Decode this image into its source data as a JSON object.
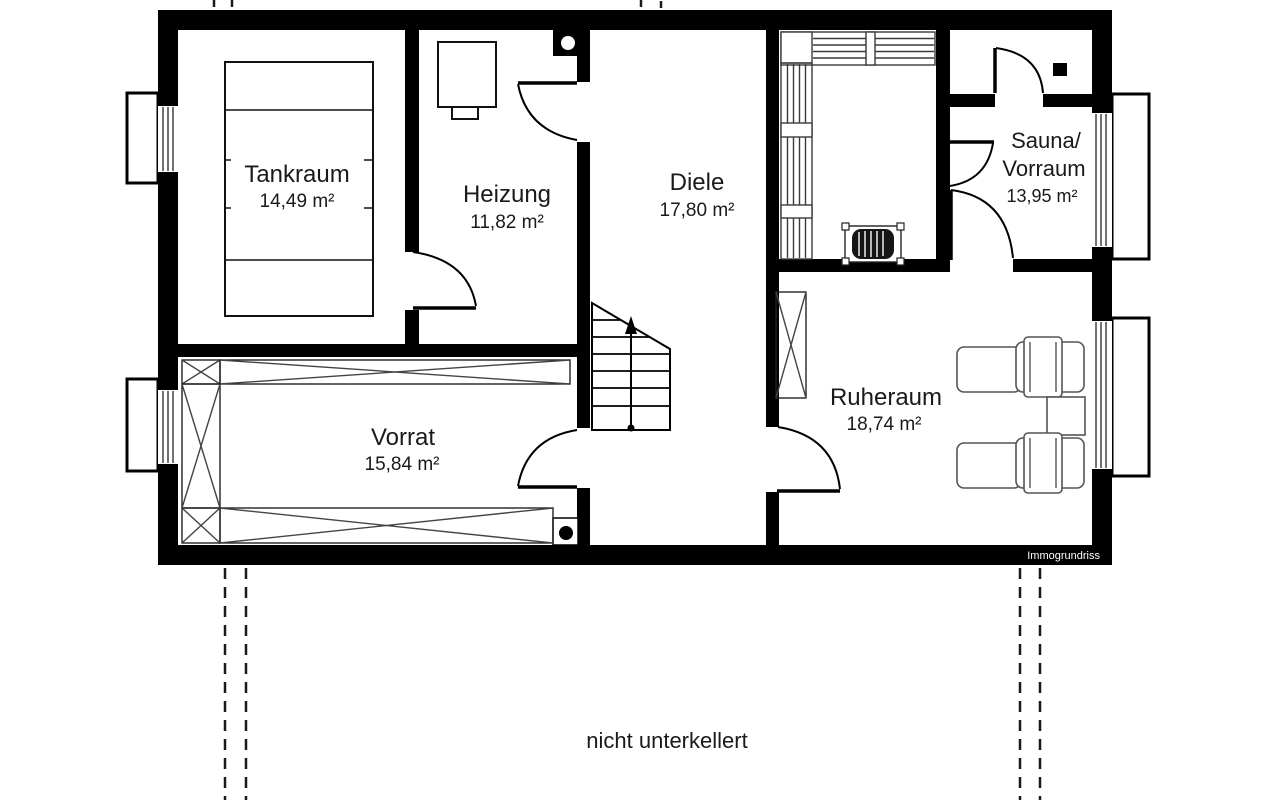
{
  "plan": {
    "rooms": [
      {
        "name": "Tankraum",
        "area": "14,49 m²"
      },
      {
        "name": "Heizung",
        "area": "11,82 m²"
      },
      {
        "name": "Diele",
        "area": "17,80 m²"
      },
      {
        "name_line1": "Sauna/",
        "name_line2": "Vorraum",
        "area": "13,95 m²"
      },
      {
        "name": "Ruheraum",
        "area": "18,74 m²"
      },
      {
        "name": "Vorrat",
        "area": "15,84 m²"
      }
    ],
    "annotation": "nicht unterkellert",
    "watermark": "Immogrundriss",
    "colors": {
      "wall": "#000000",
      "background": "#ffffff",
      "furniture_line": "#555555",
      "text": "#1a1a1a"
    }
  }
}
